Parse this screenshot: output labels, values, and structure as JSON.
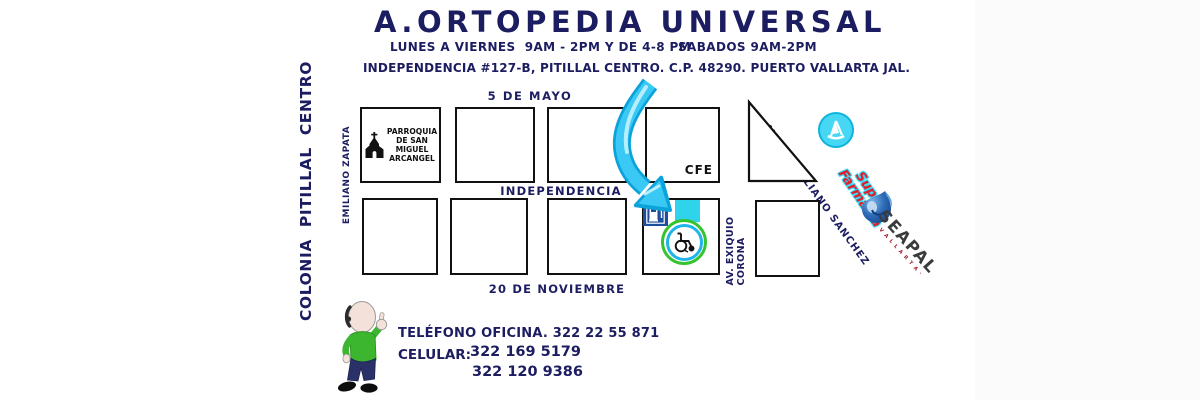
{
  "header": {
    "title": "A.ORTOPEDIA UNIVERSAL",
    "hours_weekdays": "LUNES A VIERNES  9AM - 2PM Y DE 4-8 PM",
    "hours_saturday": "SABADOS 9AM-2PM",
    "address": "INDEPENDENCIA #127-B, PITILLAL CENTRO. C.P. 48290. PUERTO VALLARTA JAL."
  },
  "map": {
    "colonia": "COLONIA  PITILLAL  CENTRO",
    "street_top": "5 DE MAYO",
    "street_middle": "INDEPENDENCIA",
    "street_bottom": "20 DE NOVIEMBRE",
    "street_left": "EMILIANO ZAPATA",
    "street_right_line1": "AV. EXIQUIO",
    "street_right_line2": "CORONA",
    "street_diagonal": "AV. PRISCILIANO SANCHEZ",
    "church_lines": [
      "PARROQUIA",
      "DE SAN",
      "MIGUEL",
      "ARCANGEL"
    ],
    "cfe": "CFE",
    "farmacia_line1": "Super",
    "farmacia_line2": "Farmacia",
    "seapal": "SEAPAL",
    "seapal_sub": "· V A L L A R T A ·"
  },
  "contact": {
    "office_phone": "TELÉFONO OFICINA. 322 22 55 871",
    "cell_label": "CELULAR:",
    "cell1": "322 169 5179",
    "cell2": "322 120 9386"
  },
  "colors": {
    "navy_text": "#1c1c61",
    "arrow_cyan": "#3ac8f4",
    "arrow_edge": "#0ca3da",
    "cyan_square": "#2fd3ec",
    "pump_blue": "#1d4e9e",
    "ring_green": "#35c42f",
    "ring_cyan": "#1fb4ea",
    "farmacia_red": "#e31d25",
    "shirt_green": "#3cb62e"
  }
}
